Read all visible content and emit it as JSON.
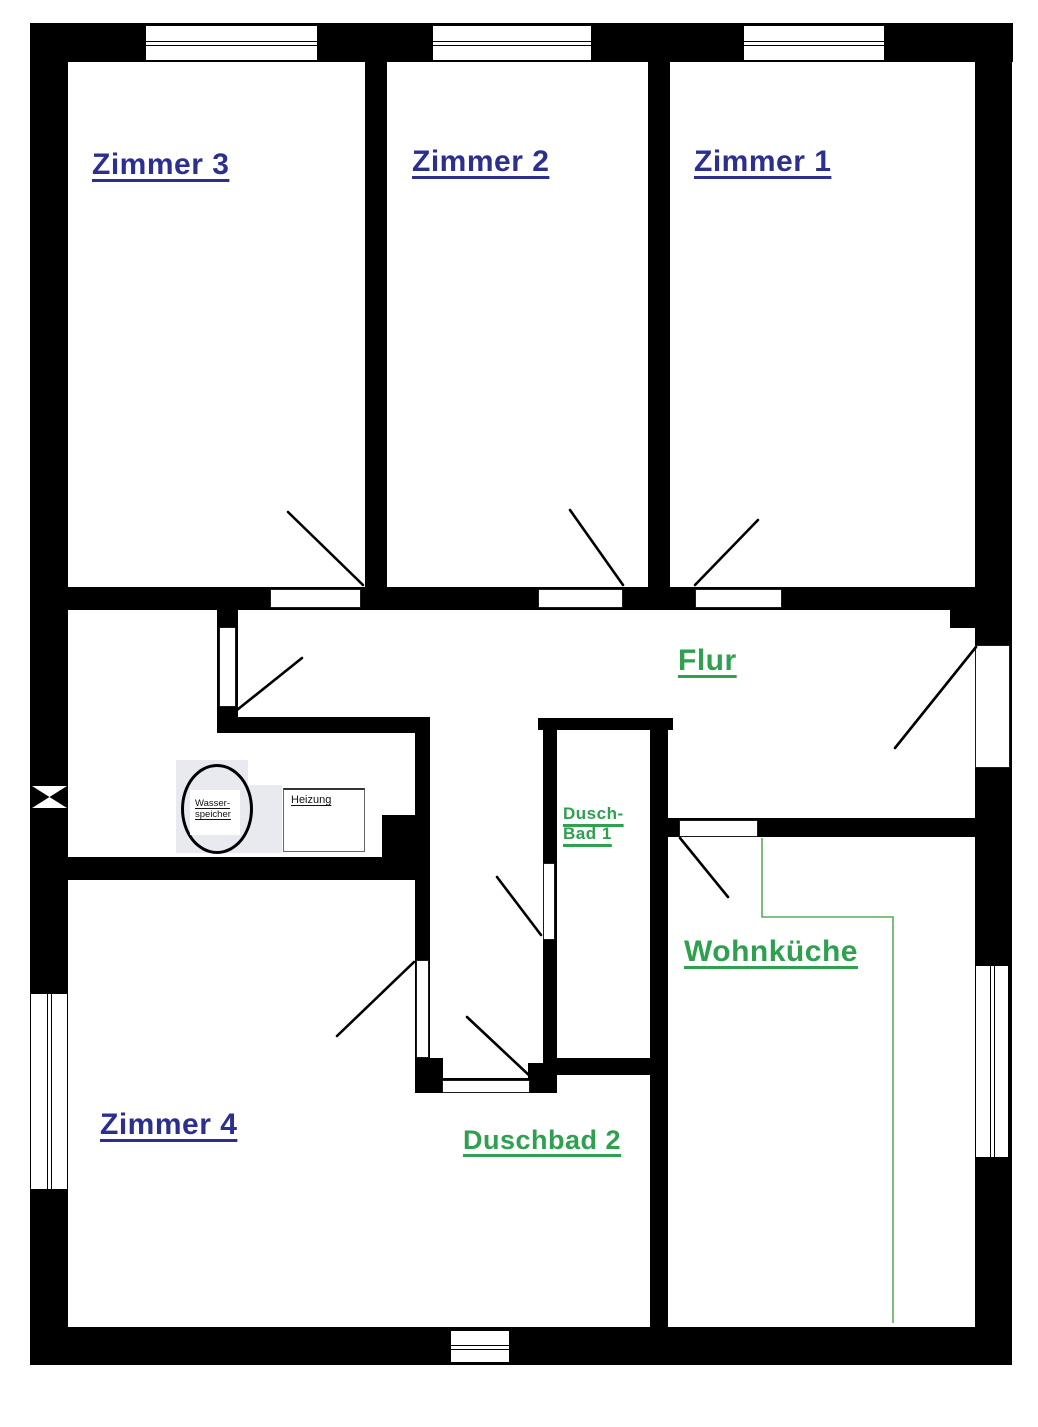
{
  "palette": {
    "wall": "#000000",
    "blue": "#2c2f8e",
    "green": "#2fa050",
    "black": "#111111",
    "kitchen_line": "#58ad58",
    "equip_gray": "#e9eaf0"
  },
  "labels": {
    "zimmer3": {
      "text": "Zimmer 3",
      "x": 92,
      "y": 147,
      "size": 30,
      "color": "blue"
    },
    "zimmer2": {
      "text": "Zimmer 2",
      "x": 412,
      "y": 144,
      "size": 30,
      "color": "blue"
    },
    "zimmer1": {
      "text": "Zimmer 1",
      "x": 694,
      "y": 144,
      "size": 30,
      "color": "blue"
    },
    "zimmer4": {
      "text": "Zimmer 4",
      "x": 100,
      "y": 1107,
      "size": 30,
      "color": "blue"
    },
    "flur": {
      "text": "Flur",
      "x": 678,
      "y": 643,
      "size": 30,
      "color": "green"
    },
    "wohnkueche": {
      "text": "Wohnküche",
      "x": 684,
      "y": 934,
      "size": 30,
      "color": "green"
    },
    "duschbad2": {
      "text": "Duschbad 2",
      "x": 463,
      "y": 1124,
      "size": 27,
      "color": "green"
    },
    "duschbad1": {
      "text": "Dusch-\nBad 1",
      "x": 563,
      "y": 804,
      "size": 17,
      "color": "green"
    },
    "wasserspeicher": {
      "text": "Wasser-\nspeicher",
      "x": 195,
      "y": 798,
      "size": 9.5,
      "color": "black"
    },
    "heizung": {
      "text": "Heizung",
      "x": 291,
      "y": 794,
      "size": 11,
      "color": "black"
    }
  },
  "plan": {
    "width": 1038,
    "height": 1427,
    "walls": [
      [
        30,
        23,
        983,
        39
      ],
      [
        30,
        23,
        38,
        1342
      ],
      [
        975,
        23,
        37,
        1342
      ],
      [
        30,
        1327,
        982,
        38
      ],
      [
        365,
        62,
        22,
        525
      ],
      [
        648,
        62,
        22,
        525
      ],
      [
        68,
        587,
        907,
        23
      ],
      [
        950,
        610,
        25,
        18
      ],
      [
        217,
        610,
        21,
        123
      ],
      [
        217,
        717,
        213,
        16
      ],
      [
        415,
        717,
        15,
        376
      ],
      [
        382,
        815,
        48,
        42
      ],
      [
        68,
        857,
        362,
        23
      ],
      [
        538,
        718,
        135,
        12
      ],
      [
        543,
        730,
        14,
        328
      ],
      [
        650,
        718,
        18,
        609
      ],
      [
        543,
        1058,
        125,
        17
      ],
      [
        528,
        1063,
        29,
        30
      ],
      [
        415,
        1078,
        142,
        15
      ],
      [
        415,
        1058,
        28,
        35
      ],
      [
        660,
        818,
        315,
        19
      ]
    ],
    "windows": [
      {
        "x": 145,
        "y": 25,
        "w": 173,
        "h": 36,
        "o": "h"
      },
      {
        "x": 432,
        "y": 25,
        "w": 160,
        "h": 36,
        "o": "h"
      },
      {
        "x": 743,
        "y": 25,
        "w": 142,
        "h": 36,
        "o": "h"
      },
      {
        "x": 30,
        "y": 993,
        "w": 38,
        "h": 197,
        "o": "v"
      },
      {
        "x": 975,
        "y": 965,
        "w": 34,
        "h": 193,
        "o": "v"
      },
      {
        "x": 450,
        "y": 1330,
        "w": 60,
        "h": 33,
        "o": "h"
      }
    ],
    "doors": [
      {
        "x": 270,
        "y": 589,
        "w": 91,
        "h": 19
      },
      {
        "x": 538,
        "y": 589,
        "w": 85,
        "h": 19
      },
      {
        "x": 695,
        "y": 589,
        "w": 87,
        "h": 19
      },
      {
        "x": 219,
        "y": 627,
        "w": 17,
        "h": 80
      },
      {
        "x": 975,
        "y": 645,
        "w": 35,
        "h": 123
      },
      {
        "x": 416,
        "y": 960,
        "w": 13,
        "h": 98
      },
      {
        "x": 543,
        "y": 863,
        "w": 12,
        "h": 77
      },
      {
        "x": 442,
        "y": 1080,
        "w": 88,
        "h": 13
      },
      {
        "x": 679,
        "y": 820,
        "w": 79,
        "h": 17
      }
    ],
    "swings": [
      [
        363,
        585,
        288,
        512
      ],
      [
        623,
        585,
        570,
        510
      ],
      [
        695,
        585,
        758,
        520
      ],
      [
        237,
        710,
        302,
        658
      ],
      [
        976,
        647,
        895,
        748
      ],
      [
        680,
        838,
        728,
        897
      ],
      [
        414,
        962,
        337,
        1036
      ],
      [
        541,
        935,
        497,
        877
      ],
      [
        532,
        1078,
        467,
        1017
      ]
    ],
    "kitchen_line": [
      [
        762,
        838
      ],
      [
        762,
        917
      ],
      [
        893,
        917
      ],
      [
        893,
        1323
      ]
    ],
    "equip_rects": [
      {
        "x": 176,
        "y": 760,
        "w": 72,
        "h": 93,
        "fill": "gray"
      },
      {
        "x": 248,
        "y": 785,
        "w": 34,
        "h": 68,
        "fill": "gray"
      },
      {
        "x": 283,
        "y": 788,
        "w": 82,
        "h": 64,
        "fill": "white",
        "border": true
      },
      {
        "x": 190,
        "y": 790,
        "w": 50,
        "h": 45,
        "fill": "white"
      }
    ],
    "boiler_ellipse": {
      "cx": 217,
      "cy": 809,
      "rx": 33,
      "ry": 42
    },
    "bowtie": {
      "x": 32,
      "y": 786,
      "w": 35,
      "h": 22
    }
  }
}
